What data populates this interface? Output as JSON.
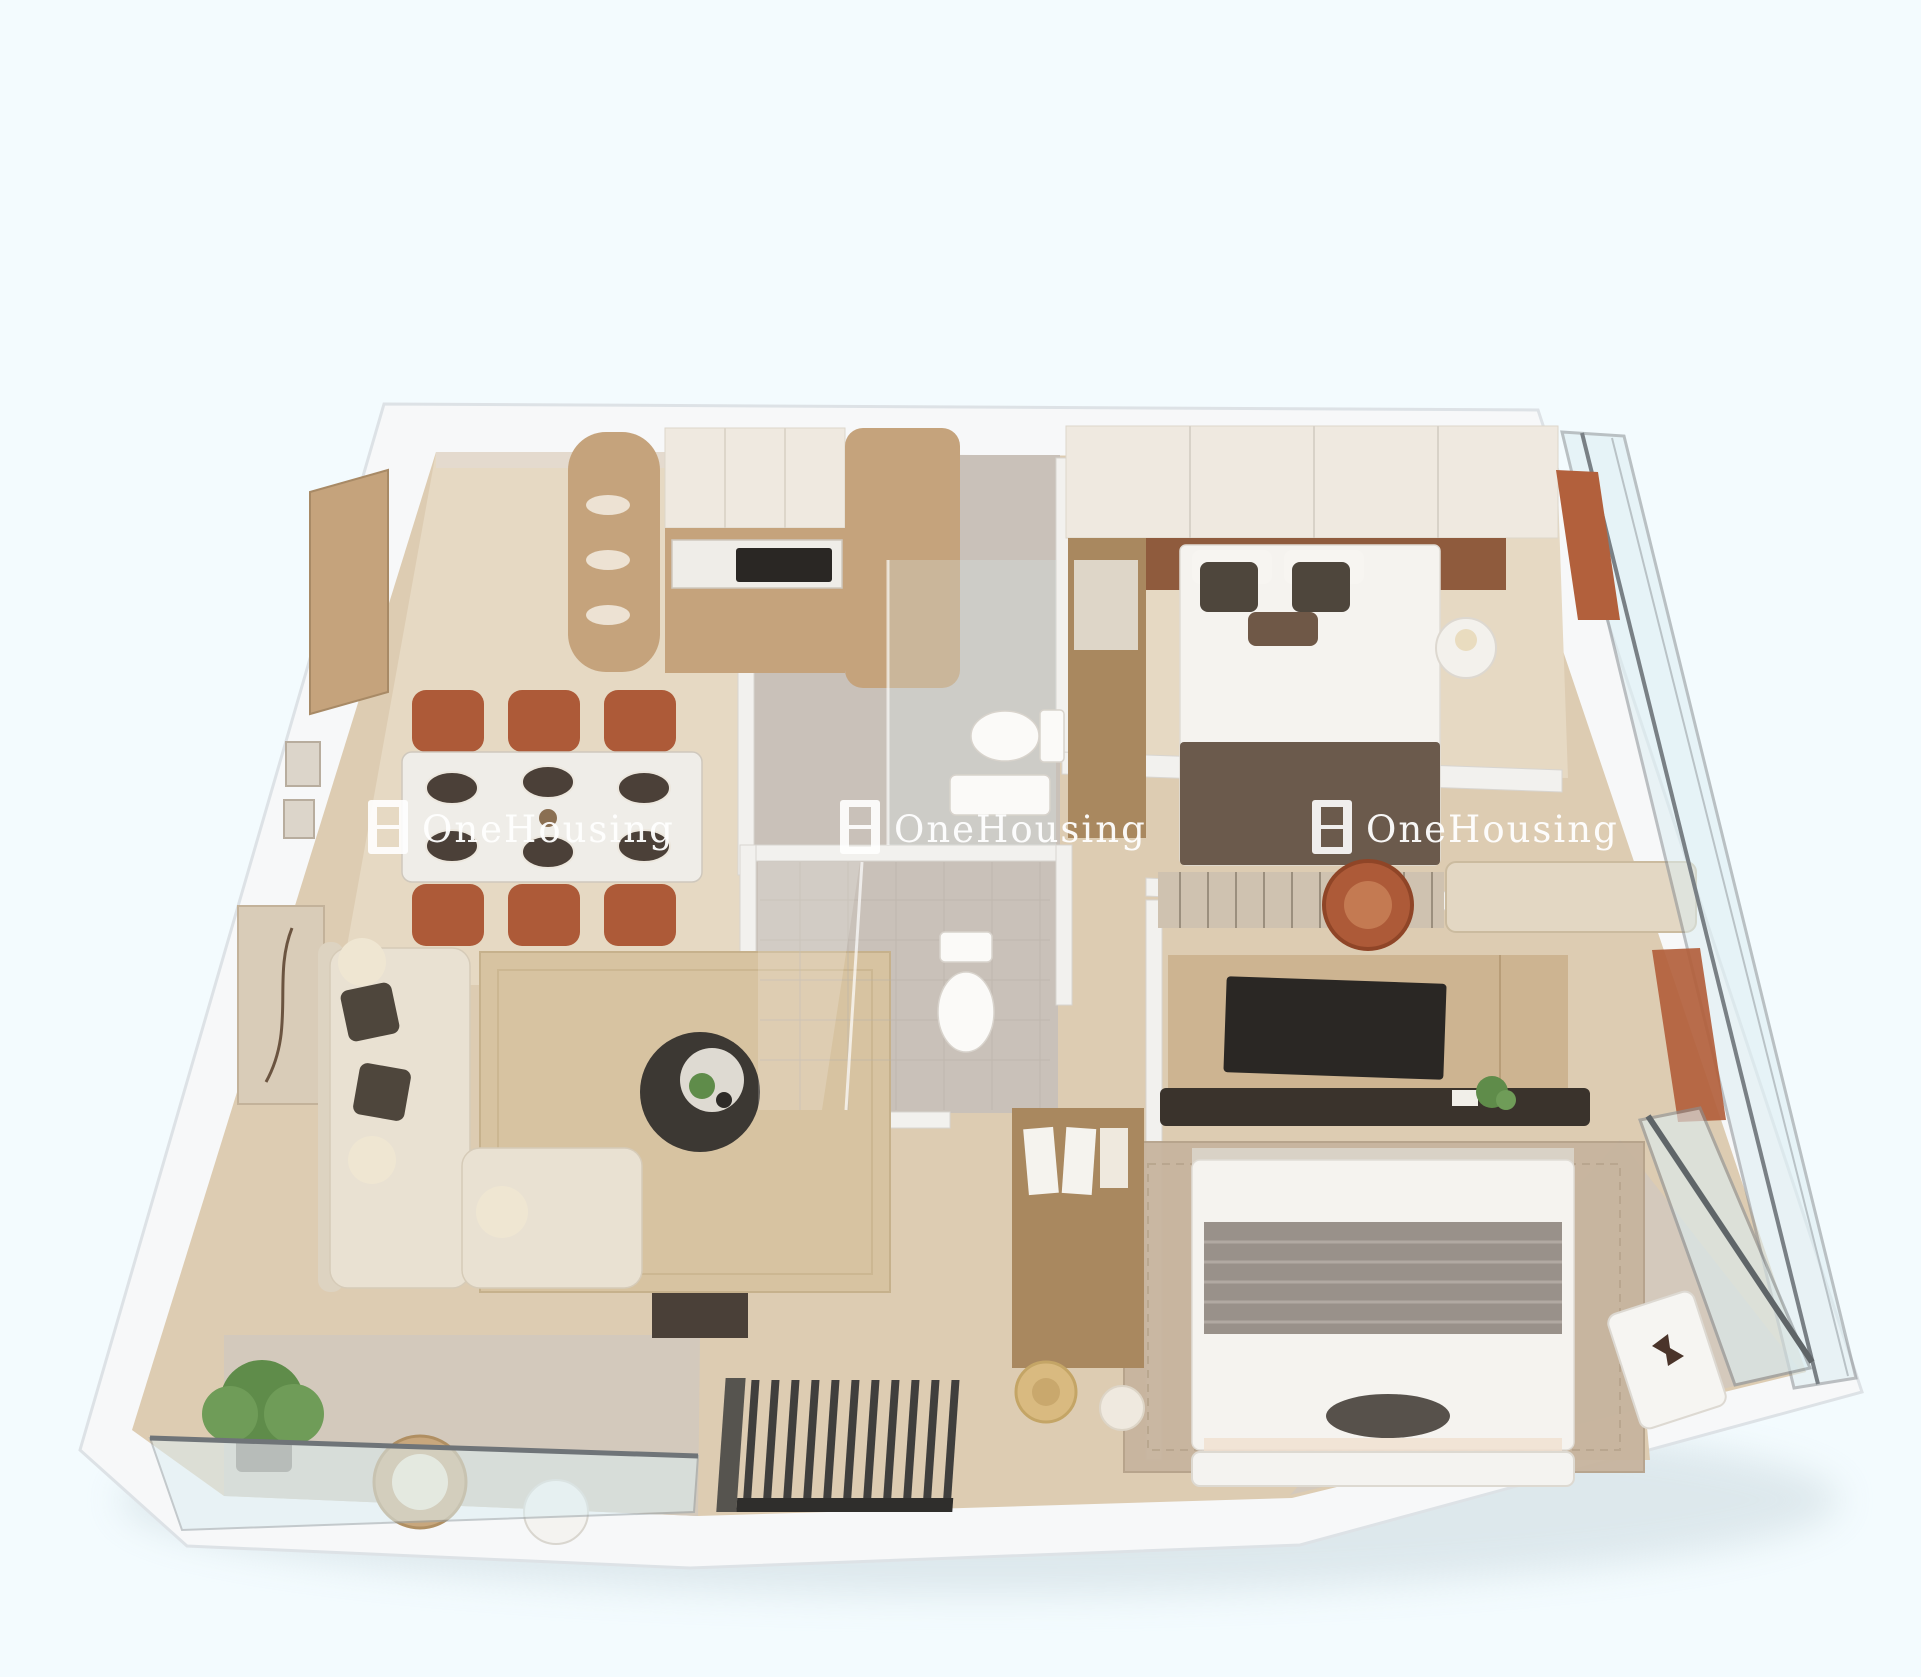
{
  "scene": {
    "title": "3D rendered floor plan of a two-bedroom apartment (top-down dollhouse view)",
    "background": "#f3fbfe"
  },
  "watermark": {
    "text": "OneHousing",
    "logo": "window-grid-logo",
    "color": "#ffffff",
    "count": 3
  },
  "palette": {
    "background": "#f3fbfe",
    "outer_wall": "#f7f8f9",
    "wall_edge": "#dde2e6",
    "inner_wall": "#f2f1ee",
    "wood_floor": "#ddccb2",
    "wood_floor_light": "#e6d9c3",
    "tile_floor": "#c9c1b9",
    "balcony_floor": "#d3c9bc",
    "cabinet_wood": "#c5a37c",
    "cabinet_wood_dark": "#a9885f",
    "cabinet_white": "#efe9e0",
    "terracotta": "#ad5a38",
    "accent_orange": "#b2603c",
    "sofa_cream": "#e9e1d2",
    "rug_jute": "#d7c3a1",
    "rug_master": "#c7b49e",
    "dark_wood": "#3c3833",
    "charcoal": "#2a2724",
    "bed_white": "#f5f3ef",
    "throw_brown": "#6b5a4c",
    "blanket_gray": "#99918a",
    "headboard_brown": "#8f5b3d",
    "glass": "#dceef2",
    "glass_frame": "#7d8488",
    "plant_green": "#5f8c4a",
    "marble": "#efede8",
    "shadow": "#c3d2d8",
    "watermark": "#ffffff"
  },
  "rooms": [
    {
      "name": "kitchen-dining",
      "items": [
        "entry-door",
        "curved-display-shelf",
        "kitchen-cabinets",
        "cooktop",
        "marble-dining-table",
        "dining-chairs (6)",
        "wall-frames"
      ]
    },
    {
      "name": "living-room",
      "items": [
        "l-shaped-sofa",
        "throw-cushions",
        "round-coffee-table",
        "jute-rug",
        "wall-art-panel",
        "dark-media-wall"
      ]
    },
    {
      "name": "living-balcony",
      "items": [
        "potted-plant",
        "rattan-armchair",
        "round-side-table",
        "glass-railing",
        "metal-grille"
      ]
    },
    {
      "name": "entrance-bathroom",
      "items": [
        "toilet",
        "vanity-counter",
        "glass-door"
      ]
    },
    {
      "name": "central-bathroom",
      "items": [
        "glass-shower-enclosure",
        "toilet",
        "tiled-floor"
      ]
    },
    {
      "name": "bedroom-1",
      "items": [
        "double-bed",
        "brown-throw-blanket",
        "patterned-pillows",
        "headboard-accent-wall",
        "built-in-wardrobe",
        "bedside-table",
        "table-lamp",
        "striped-runner-rug",
        "upholstered-bench",
        "terracotta-chair"
      ]
    },
    {
      "name": "master-bedroom",
      "items": [
        "double-bed",
        "grey-striped-blanket",
        "tv-media-wall",
        "media-console",
        "open-wardrobe",
        "straw-hat",
        "pouf",
        "patterned-rug",
        "foot-bench"
      ]
    },
    {
      "name": "master-balcony",
      "items": [
        "glass-railing",
        "white-bench",
        "butterfly-decor"
      ]
    }
  ]
}
